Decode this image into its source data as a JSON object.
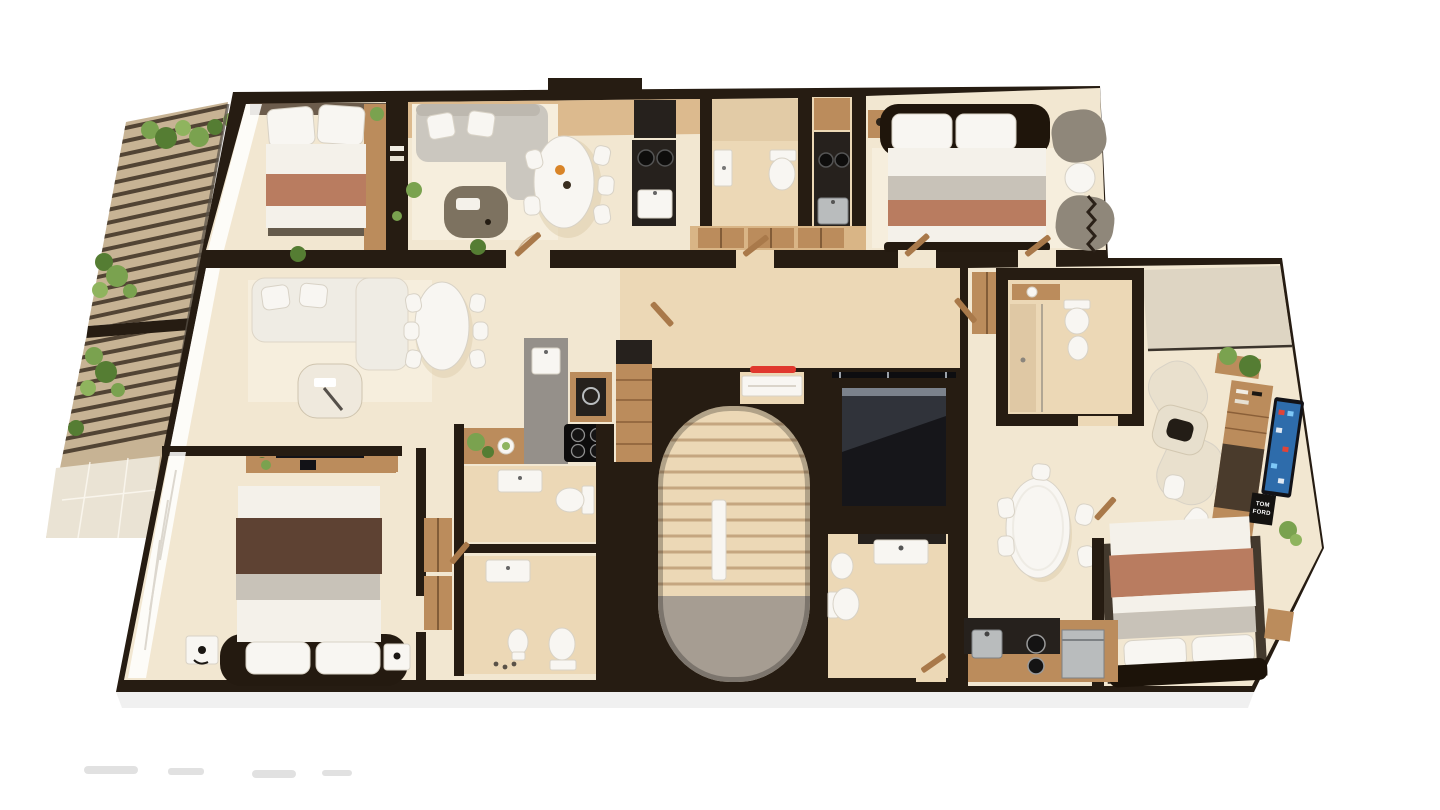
{
  "scene": {
    "description": "Top-down 3D architectural render of a residential apartment floor plan with three units, central curved stair core and elevator, and planted terraces on the left",
    "view": "top-down-3d-render"
  },
  "poster": {
    "line1": "TOM",
    "line2": "FORD"
  },
  "colors": {
    "background": "#ffffff",
    "wall": "#261c12",
    "floorCream": "#f2e7d1",
    "floorWarm": "#ecd8b6",
    "floorWood": "#d9b586",
    "rug": "#f6eedd",
    "wood": "#bb8c5c",
    "woodDark": "#8a5f38",
    "counter": "#26211d",
    "stone": "#95908a",
    "white": "#f8f6f2",
    "fixtureStroke": "#d8d2c6",
    "bedWhite": "#f4f1ea",
    "bedGrey": "#c8c2b8",
    "terracotta": "#b97c60",
    "blanketBrown": "#5e4233",
    "sofaGrey": "#cbc7bf",
    "sofaLight": "#efece4",
    "chairCream": "#e9e0cd",
    "armGrey": "#8f877a",
    "green1": "#7aa24f",
    "green2": "#557d33",
    "green3": "#8fb45e",
    "balconyTile": "#c7b394",
    "paveTile": "#eae3d4",
    "stairTread": "#c3a47e",
    "landingGrey": "#9e978e",
    "elevatorDark": "#16161a",
    "elevatorSheen": "#49505a",
    "accentRed": "#e0382e",
    "tvBlue": "#2e6cab",
    "tvFrame": "#121217",
    "doorWood": "#a9794a",
    "slat": "#35281c",
    "glassLine": "#5a5248",
    "curtainWhite": "#ffffff",
    "applianceSilver": "#b9bcbd",
    "shadowInk": "#000000"
  },
  "rooms": [
    {
      "id": "bedroom-top-left",
      "furniture": [
        "double-bed",
        "pillows",
        "terracotta-throw",
        "wood-shelf-column",
        "bookshelf-partition",
        "plant"
      ]
    },
    {
      "id": "living-dining-top-left",
      "furniture": [
        "corner-sofa",
        "coffee-table",
        "oval-dining-table",
        "six-chairs",
        "fruit-bowl",
        "plants"
      ]
    },
    {
      "id": "kitchen-top-left",
      "furniture": [
        "tall-fridge-unit",
        "dark-counter",
        "two-ring-cooktop",
        "sink"
      ]
    },
    {
      "id": "bathroom-top-left",
      "furniture": [
        "wall-sink",
        "toilet",
        "shower-zone"
      ]
    },
    {
      "id": "kitchenette-top",
      "furniture": [
        "upper-cabinet",
        "dark-counter",
        "two-ring-cooktop",
        "sink"
      ]
    },
    {
      "id": "hall-top",
      "furniture": [
        "wood-wardrobes"
      ]
    },
    {
      "id": "bedroom-top-right",
      "furniture": [
        "double-bed",
        "rug",
        "nightstand",
        "two-armchairs",
        "round-side-table",
        "curtain"
      ]
    },
    {
      "id": "living-room-middle-left",
      "furniture": [
        "white-sofa",
        "coffee-table",
        "oval-dining-table",
        "six-chairs",
        "tv-console"
      ]
    },
    {
      "id": "kitchen-middle",
      "furniture": [
        "stone-counter-with-sink",
        "oven-column",
        "induction-hob",
        "tall-wood-cabinet",
        "plant",
        "salad-bowl"
      ]
    },
    {
      "id": "bedroom-bottom-left",
      "furniture": [
        "double-bed",
        "brown-blanket",
        "nightstands",
        "lamps",
        "tv-console",
        "curtain-wall",
        "wardrobes"
      ]
    },
    {
      "id": "bathroom-middle-upper",
      "furniture": [
        "sink",
        "toilet"
      ]
    },
    {
      "id": "bathroom-middle-lower",
      "furniture": [
        "sink",
        "bidet",
        "toilet",
        "toiletries"
      ]
    },
    {
      "id": "stairwell-core",
      "furniture": [
        "curved-stair-opening",
        "treads",
        "white-entry-door",
        "red-handrail",
        "landing"
      ]
    },
    {
      "id": "elevator",
      "furniture": [
        "elevator-cab",
        "guide-rails"
      ]
    },
    {
      "id": "bathroom-core",
      "furniture": [
        "wall-sink",
        "bidet",
        "toilet"
      ]
    },
    {
      "id": "bathroom-right",
      "furniture": [
        "wood-vanity",
        "toilet",
        "bidet",
        "shower-glass"
      ]
    },
    {
      "id": "living-room-right",
      "furniture": [
        "two-cream-armchairs",
        "dark-coffee-table",
        "media-shelf",
        "smart-tv",
        "poster",
        "plants",
        "glazed-balcony-strip"
      ]
    },
    {
      "id": "dining-right",
      "furniture": [
        "oval-dining-table",
        "five-chairs"
      ]
    },
    {
      "id": "bedroom-bottom-right",
      "furniture": [
        "double-bed",
        "terracotta-throw",
        "nightstands"
      ]
    },
    {
      "id": "kitchen-right",
      "furniture": [
        "wood-counter",
        "dark-counter",
        "sink",
        "two-ring-cooktop",
        "silver-appliance"
      ]
    },
    {
      "id": "terrace-upper-left",
      "furniture": [
        "pergola-slats",
        "planters",
        "shrubs"
      ]
    },
    {
      "id": "terrace-lower-left",
      "furniture": [
        "pergola-slats",
        "planters",
        "tile-paving"
      ]
    }
  ]
}
